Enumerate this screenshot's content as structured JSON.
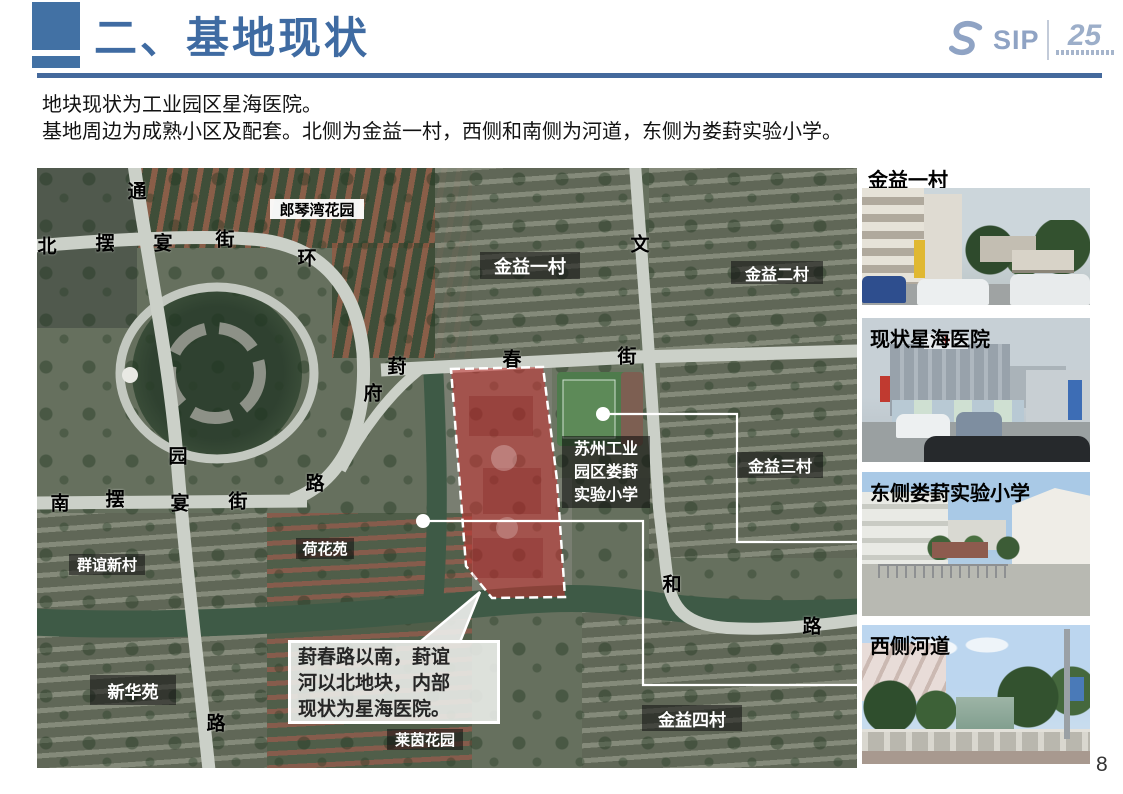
{
  "slide": {
    "title": "二、基地现状",
    "intro_line1": "地块现状为工业园区星海医院。",
    "intro_line2": "基地周边为成熟小区及配套。北侧为金益一村，西侧和南侧为河道，东侧为娄葑实验小学。",
    "page_number": "8"
  },
  "logo": {
    "brand": "SIP",
    "anniversary": "25"
  },
  "map": {
    "street_labels": [
      {
        "text": "通"
      },
      {
        "text": "北"
      },
      {
        "text": "摆"
      },
      {
        "text": "宴"
      },
      {
        "text": "街"
      },
      {
        "text": "环"
      },
      {
        "text": "文"
      },
      {
        "text": "葑"
      },
      {
        "text": "春"
      },
      {
        "text": "街"
      },
      {
        "text": "府"
      },
      {
        "text": "园"
      },
      {
        "text": "路"
      },
      {
        "text": "南"
      },
      {
        "text": "摆"
      },
      {
        "text": "宴"
      },
      {
        "text": "街"
      },
      {
        "text": "和"
      },
      {
        "text": "路"
      },
      {
        "text": "路"
      }
    ],
    "area_labels": [
      {
        "text": "郎琴湾花园"
      },
      {
        "text": "金益一村"
      },
      {
        "text": "金益二村"
      },
      {
        "text": "金益三村"
      },
      {
        "text": "荷花苑"
      },
      {
        "text": "群谊新村"
      },
      {
        "text": "新华苑"
      },
      {
        "text": "莱茵花园"
      },
      {
        "text": "金益四村"
      }
    ],
    "school_label": {
      "line1": "苏州工业",
      "line2": "园区娄葑",
      "line3": "实验小学"
    },
    "callout": {
      "line1": "葑春路以南，葑谊",
      "line2": "河以北地块，内部",
      "line3": "现状为星海医院。"
    }
  },
  "photos": [
    {
      "label": "金益一村"
    },
    {
      "label": "现状星海医院"
    },
    {
      "label": "东侧娄葑实验小学"
    },
    {
      "label": "西侧河道"
    }
  ],
  "colors": {
    "accent_blue": "#3f6ba2",
    "site_red": "rgba(198,48,48,0.55)",
    "river_green": "#3e5a46"
  }
}
